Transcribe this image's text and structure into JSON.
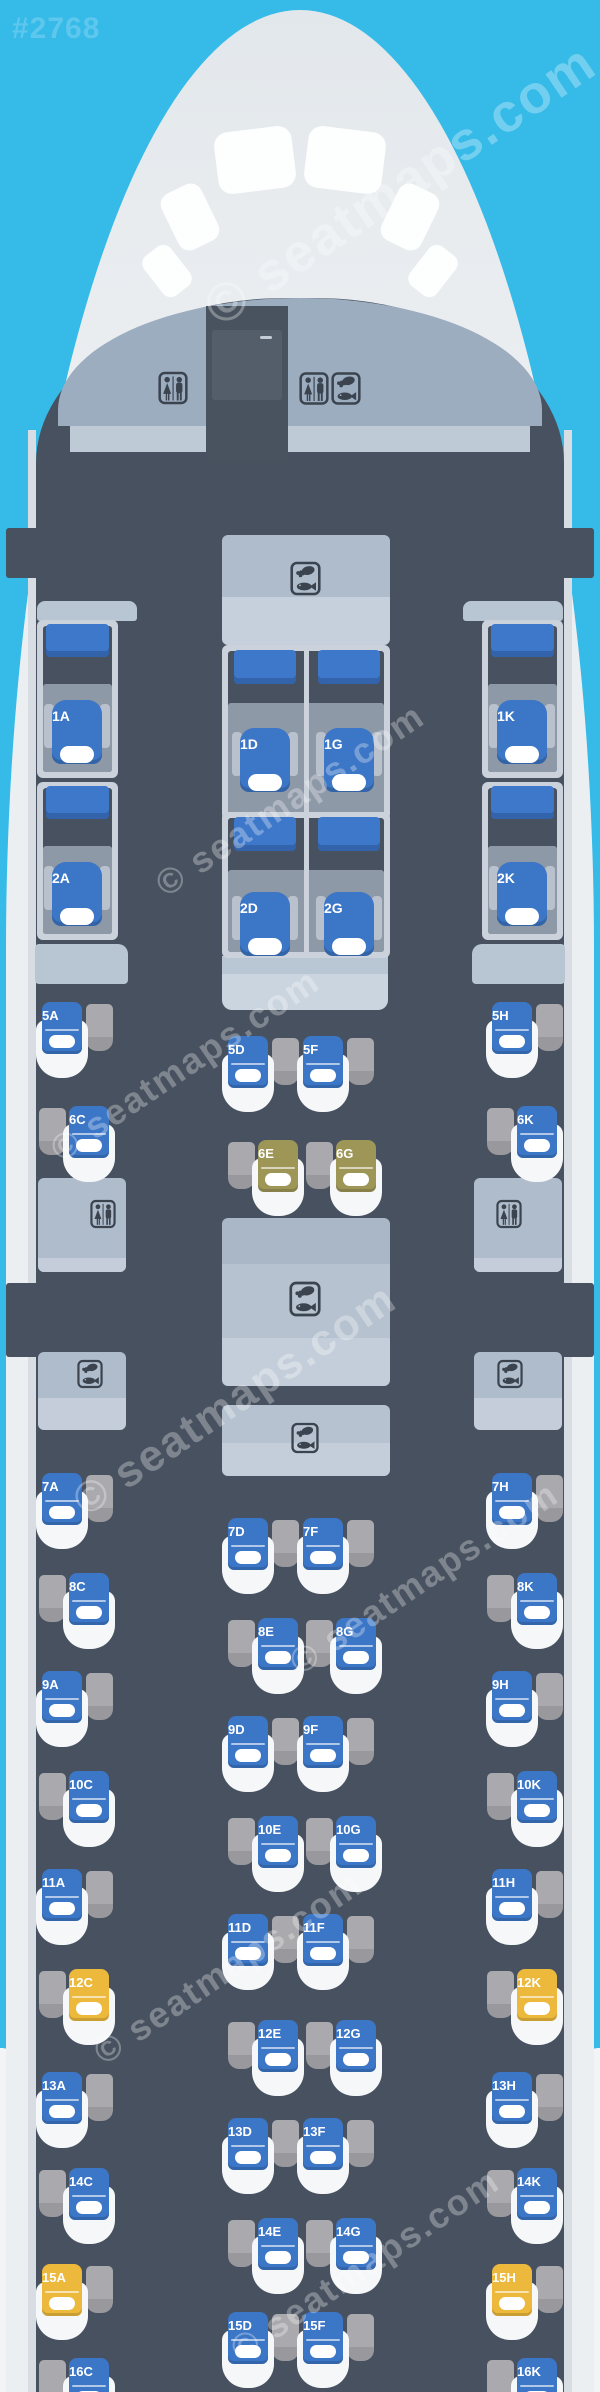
{
  "meta": {
    "map_id": "#2768",
    "watermark": "© seatmaps.com"
  },
  "colors": {
    "sky": "#36BAE8",
    "fuselage": "#ECEFF2",
    "cabin_floor": "#47515F",
    "seat_blue": "#3C76C6",
    "seat_yellow": "#ECB93C",
    "seat_olive": "#9E9657",
    "seat_shell": "#F5F7F9",
    "side_table": "#A9A9AE",
    "panel": "#AEBCCC",
    "suite_wall": "#CBD2DC"
  },
  "icons": {
    "lavatory": "wc-icon",
    "galley": "meal-icon"
  },
  "first_class": {
    "rows": [
      {
        "row": "1",
        "seats": [
          {
            "id": "1A",
            "letter": "A"
          },
          {
            "id": "1D",
            "letter": "D"
          },
          {
            "id": "1G",
            "letter": "G"
          },
          {
            "id": "1K",
            "letter": "K"
          }
        ]
      },
      {
        "row": "2",
        "seats": [
          {
            "id": "2A",
            "letter": "A"
          },
          {
            "id": "2D",
            "letter": "D"
          },
          {
            "id": "2G",
            "letter": "G"
          },
          {
            "id": "2K",
            "letter": "K"
          }
        ]
      }
    ]
  },
  "business": {
    "seats": [
      {
        "id": "5A",
        "row": "5",
        "letter": "A",
        "color": "blue"
      },
      {
        "id": "5D",
        "row": "5",
        "letter": "D",
        "color": "blue"
      },
      {
        "id": "5F",
        "row": "5",
        "letter": "F",
        "color": "blue"
      },
      {
        "id": "5H",
        "row": "5",
        "letter": "H",
        "color": "blue"
      },
      {
        "id": "6C",
        "row": "6",
        "letter": "C",
        "color": "blue"
      },
      {
        "id": "6E",
        "row": "6",
        "letter": "E",
        "color": "olive"
      },
      {
        "id": "6G",
        "row": "6",
        "letter": "G",
        "color": "olive"
      },
      {
        "id": "6K",
        "row": "6",
        "letter": "K",
        "color": "blue"
      },
      {
        "id": "7A",
        "row": "7",
        "letter": "A",
        "color": "blue"
      },
      {
        "id": "7D",
        "row": "7",
        "letter": "D",
        "color": "blue"
      },
      {
        "id": "7F",
        "row": "7",
        "letter": "F",
        "color": "blue"
      },
      {
        "id": "7H",
        "row": "7",
        "letter": "H",
        "color": "blue"
      },
      {
        "id": "8C",
        "row": "8",
        "letter": "C",
        "color": "blue"
      },
      {
        "id": "8E",
        "row": "8",
        "letter": "E",
        "color": "blue"
      },
      {
        "id": "8G",
        "row": "8",
        "letter": "G",
        "color": "blue"
      },
      {
        "id": "8K",
        "row": "8",
        "letter": "K",
        "color": "blue"
      },
      {
        "id": "9A",
        "row": "9",
        "letter": "A",
        "color": "blue"
      },
      {
        "id": "9D",
        "row": "9",
        "letter": "D",
        "color": "blue"
      },
      {
        "id": "9F",
        "row": "9",
        "letter": "F",
        "color": "blue"
      },
      {
        "id": "9H",
        "row": "9",
        "letter": "H",
        "color": "blue"
      },
      {
        "id": "10C",
        "row": "10",
        "letter": "C",
        "color": "blue"
      },
      {
        "id": "10E",
        "row": "10",
        "letter": "E",
        "color": "blue"
      },
      {
        "id": "10G",
        "row": "10",
        "letter": "G",
        "color": "blue"
      },
      {
        "id": "10K",
        "row": "10",
        "letter": "K",
        "color": "blue"
      },
      {
        "id": "11A",
        "row": "11",
        "letter": "A",
        "color": "blue"
      },
      {
        "id": "11D",
        "row": "11",
        "letter": "D",
        "color": "blue"
      },
      {
        "id": "11F",
        "row": "11",
        "letter": "F",
        "color": "blue"
      },
      {
        "id": "11H",
        "row": "11",
        "letter": "H",
        "color": "blue"
      },
      {
        "id": "12C",
        "row": "12",
        "letter": "C",
        "color": "yellow"
      },
      {
        "id": "12E",
        "row": "12",
        "letter": "E",
        "color": "blue"
      },
      {
        "id": "12G",
        "row": "12",
        "letter": "G",
        "color": "blue"
      },
      {
        "id": "12K",
        "row": "12",
        "letter": "K",
        "color": "yellow"
      },
      {
        "id": "13A",
        "row": "13",
        "letter": "A",
        "color": "blue"
      },
      {
        "id": "13D",
        "row": "13",
        "letter": "D",
        "color": "blue"
      },
      {
        "id": "13F",
        "row": "13",
        "letter": "F",
        "color": "blue"
      },
      {
        "id": "13H",
        "row": "13",
        "letter": "H",
        "color": "blue"
      },
      {
        "id": "14C",
        "row": "14",
        "letter": "C",
        "color": "blue"
      },
      {
        "id": "14E",
        "row": "14",
        "letter": "E",
        "color": "blue"
      },
      {
        "id": "14G",
        "row": "14",
        "letter": "G",
        "color": "blue"
      },
      {
        "id": "14K",
        "row": "14",
        "letter": "K",
        "color": "blue"
      },
      {
        "id": "15A",
        "row": "15",
        "letter": "A",
        "color": "yellow"
      },
      {
        "id": "15D",
        "row": "15",
        "letter": "D",
        "color": "blue"
      },
      {
        "id": "15F",
        "row": "15",
        "letter": "F",
        "color": "blue"
      },
      {
        "id": "15H",
        "row": "15",
        "letter": "H",
        "color": "yellow"
      },
      {
        "id": "16C",
        "row": "16",
        "letter": "C",
        "color": "blue"
      },
      {
        "id": "16K",
        "row": "16",
        "letter": "K",
        "color": "blue"
      }
    ]
  },
  "facilities": {
    "front": [
      {
        "type": "lavatory",
        "icon": "wc"
      },
      {
        "type": "lavatory-galley",
        "icons": [
          "wc",
          "meal"
        ]
      },
      {
        "type": "galley",
        "icon": "meal"
      }
    ],
    "mid": [
      {
        "type": "lavatory",
        "side": "left",
        "icon": "wc"
      },
      {
        "type": "lavatory",
        "side": "right",
        "icon": "wc"
      },
      {
        "type": "galley",
        "position": "center-forward",
        "icon": "meal"
      },
      {
        "type": "galley",
        "side": "left",
        "icon": "meal"
      },
      {
        "type": "galley",
        "side": "right",
        "icon": "meal"
      },
      {
        "type": "galley",
        "position": "center-aft",
        "icon": "meal"
      }
    ]
  }
}
